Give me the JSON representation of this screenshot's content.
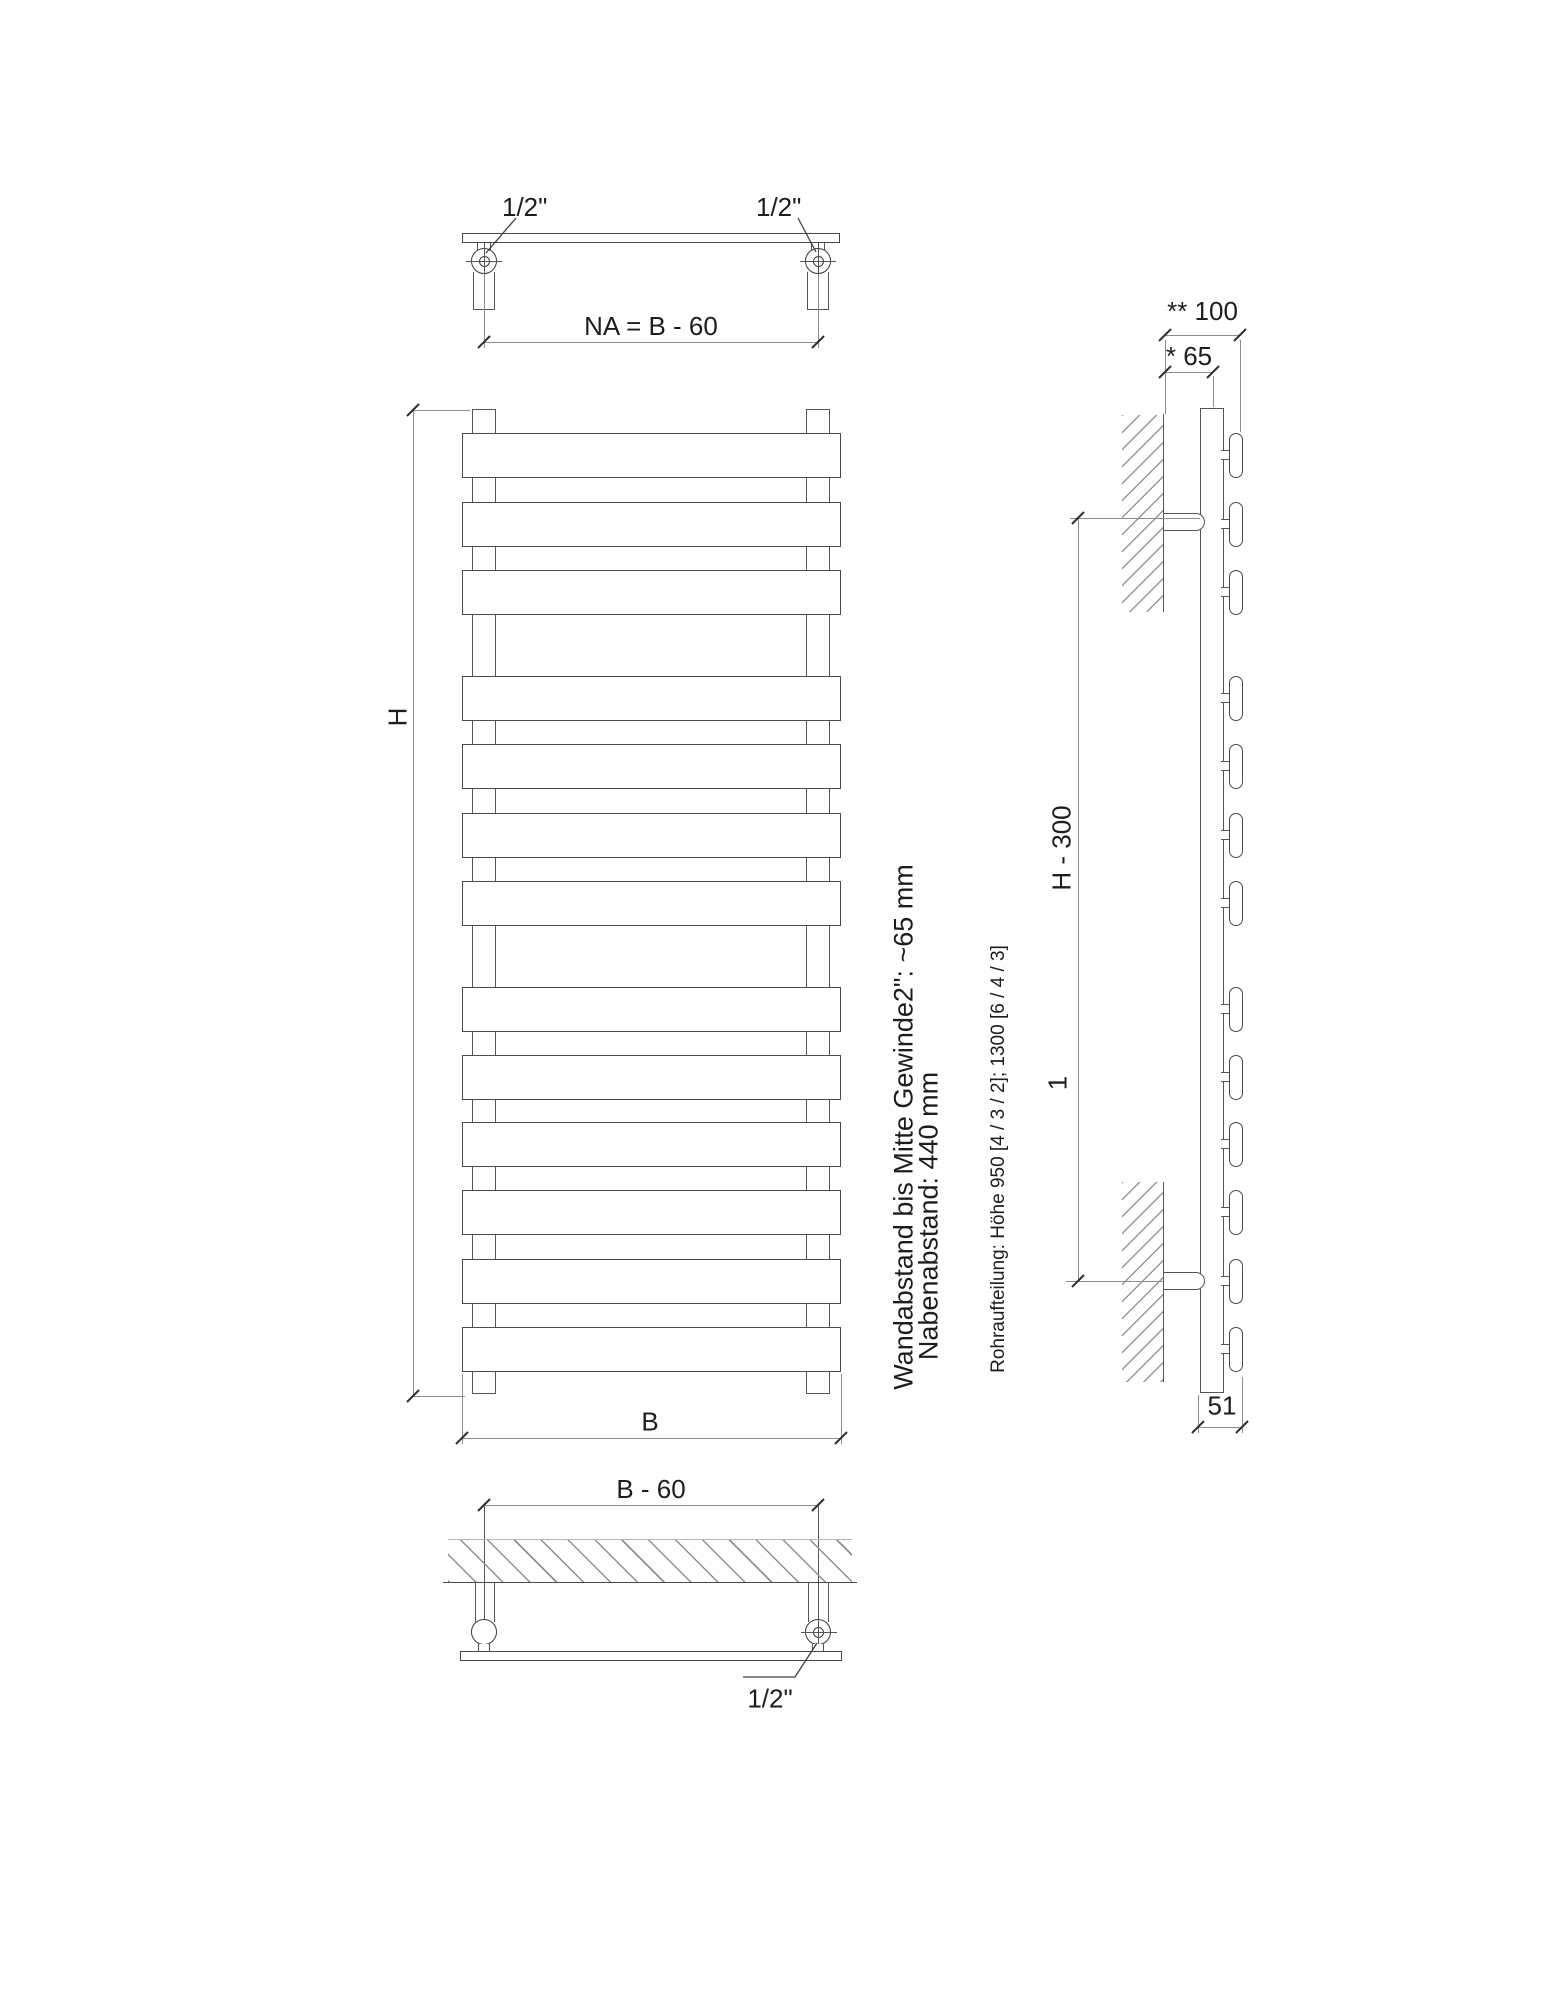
{
  "top_view": {
    "fitting_left": "1/2\"",
    "fitting_right": "1/2\"",
    "hub_dim": "NA = B - 60"
  },
  "front_view": {
    "height_dim": "H",
    "width_dim": "B"
  },
  "bottom_view": {
    "width_dim": "B - 60",
    "fitting": "1/2\""
  },
  "side_view": {
    "total_depth_dim": "** 100",
    "wall_to_center_dim": "* 65",
    "bracket_dim": "H - 300",
    "footnote": "1",
    "depth_dim": "51"
  },
  "notes": {
    "wall_distance": "Wandabstand bis Mitte Gewinde2\": ~65 mm",
    "hub_distance": "Nabenabstand: 440 mm",
    "tube_layout": "Rohraufteilung: Höhe 950 [4 / 3 / 2]; 1300 [6 / 4 / 3]"
  },
  "geometry": {
    "bar_tops": [
      433,
      502,
      570,
      676,
      744,
      813,
      881,
      987,
      1055,
      1122,
      1190,
      1259,
      1327
    ],
    "bar_height": 45,
    "bar_groups": [
      3,
      4,
      6
    ],
    "front": {
      "bar_left": 462,
      "bar_width": 379,
      "tube_left_x": 472,
      "tube_right_x": 806,
      "tube_width": 24,
      "tube_top": 409,
      "tube_height": 985
    },
    "side": {
      "capsule_left": 1229,
      "capsule_width": 14,
      "connector_left": 1221,
      "connector_offset": 17,
      "tube_left": 1200,
      "tube_top": 408,
      "tube_height": 985
    }
  },
  "colors": {
    "outline": "#4a4a4a",
    "dimension": "#8c8c8c",
    "text": "#1d1d1d",
    "background": "#ffffff"
  }
}
